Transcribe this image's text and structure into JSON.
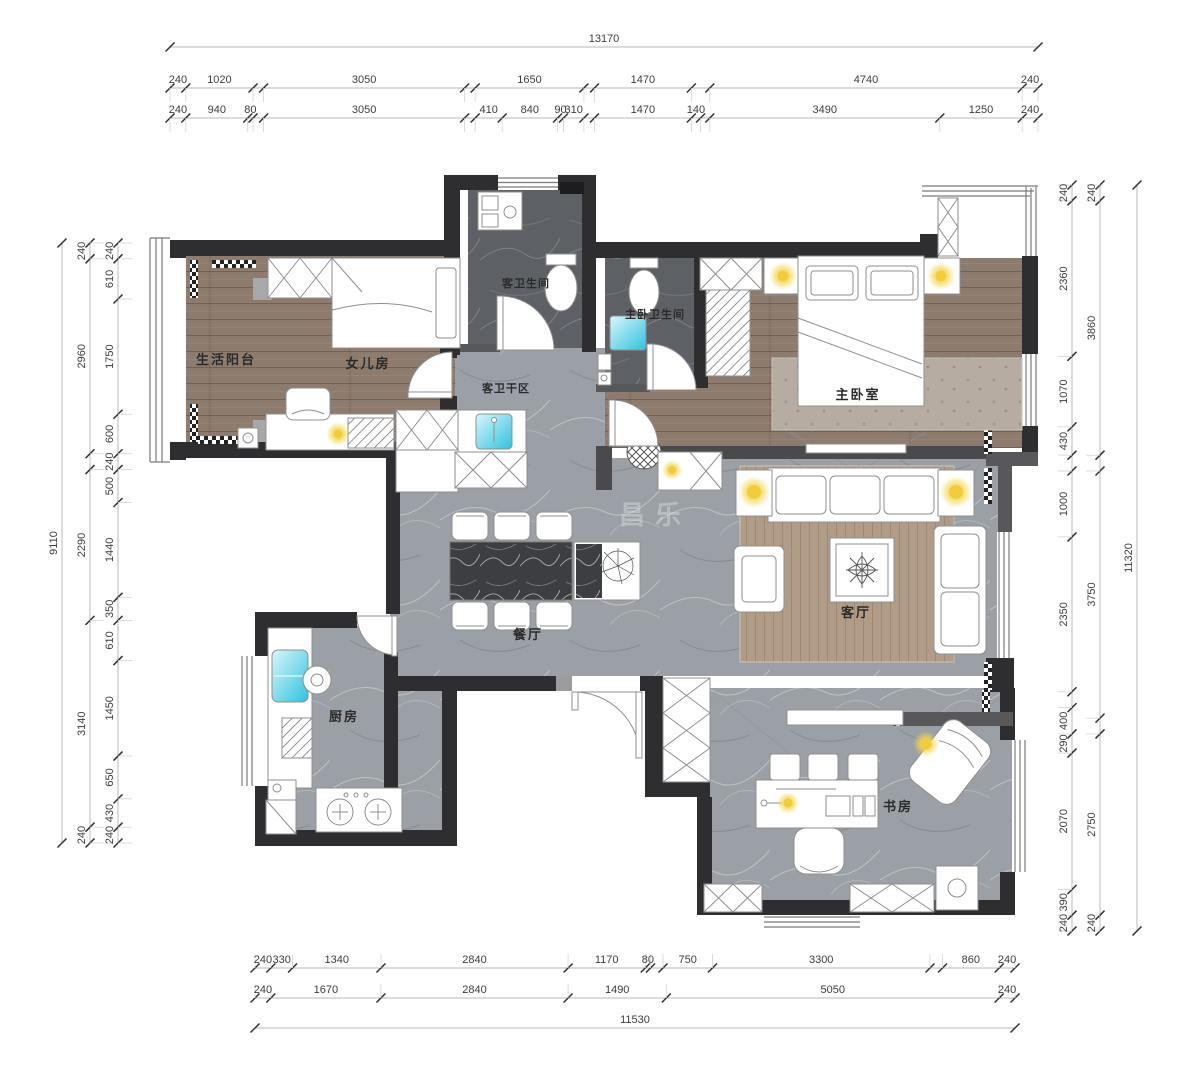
{
  "watermark": "昌乐",
  "rooms": {
    "balcony": "生活阳台",
    "daughter": "女儿房",
    "guest_bath": "客卫生间",
    "guest_bath_dry": "客卫干区",
    "master_bath": "主卧卫生间",
    "master_bedroom": "主卧室",
    "dining": "餐厅",
    "living": "客厅",
    "kitchen": "厨房",
    "study": "书房"
  },
  "dimensions": {
    "top": {
      "total": "13170",
      "row1": [
        240,
        1020,
        {
          "v": 160
        },
        3050,
        {
          "v": 160
        },
        1650,
        {
          "v": 160
        },
        1470,
        {
          "v": 280
        },
        4740,
        240
      ],
      "row2": [
        240,
        940,
        80,
        {
          "v": 160
        },
        3050,
        {
          "v": 160
        },
        410,
        840,
        90,
        310,
        {
          "v": 160
        },
        1470,
        140,
        {
          "v": 140
        },
        3490,
        1250,
        240
      ]
    },
    "bottom": {
      "row1": [
        240,
        330,
        1340,
        2840,
        1170,
        80,
        {
          "v": 190
        },
        750,
        3300,
        {
          "v": 190
        },
        860,
        240
      ],
      "row2": [
        240,
        1670,
        2840,
        1490,
        5050,
        240
      ],
      "total": "11530"
    },
    "left": {
      "total": "9110",
      "mid": [
        240,
        2960,
        {
          "v": 240
        },
        2290,
        3140,
        240
      ],
      "inner": [
        240,
        610,
        1750,
        600,
        240,
        500,
        1440,
        350,
        610,
        1450,
        650,
        430,
        240
      ]
    },
    "right": {
      "inner": [
        240,
        2360,
        1070,
        430,
        {
          "v": 240
        },
        1000,
        2350,
        {
          "v": 240
        },
        400,
        290,
        2070,
        390,
        240
      ],
      "mid": [
        240,
        3860,
        {
          "v": 240
        },
        3750,
        {
          "v": 240
        },
        2750,
        240
      ],
      "total": "11320"
    }
  }
}
